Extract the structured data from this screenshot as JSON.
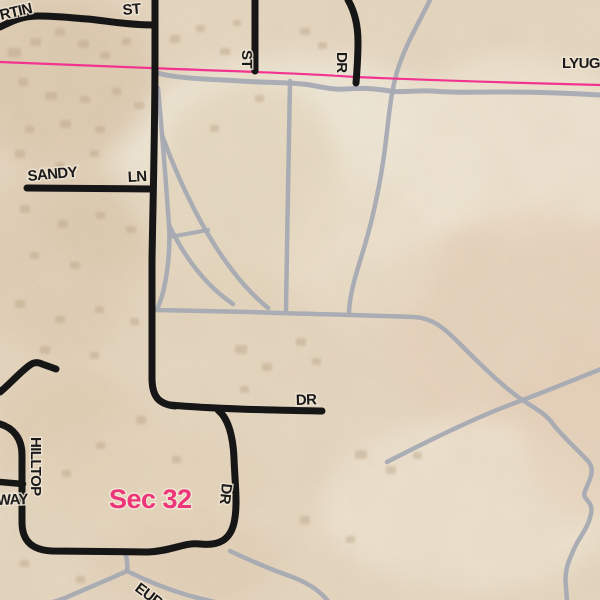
{
  "map": {
    "colors": {
      "base": "#e6d7c1",
      "road": "#161616",
      "trail": "#a6aab3",
      "boundary": "#f23390",
      "label": "#1a1a1a",
      "section_label": "#ec3679",
      "building": "#b59e7f"
    },
    "background": {
      "patches": [
        [
          300,
          165,
          190,
          110,
          "#f2ebdb",
          0.9
        ],
        [
          520,
          150,
          130,
          95,
          "#f0e6d4",
          0.85
        ],
        [
          530,
          330,
          140,
          120,
          "#e8d3bd",
          0.7
        ],
        [
          470,
          505,
          150,
          85,
          "#efe5d3",
          0.8
        ],
        [
          60,
          80,
          95,
          85,
          "#d9c4a7",
          0.55
        ],
        [
          55,
          265,
          85,
          95,
          "#dccaae",
          0.5
        ],
        [
          110,
          220,
          65,
          45,
          "#d9c6a9",
          0.45
        ],
        [
          250,
          185,
          95,
          105,
          "#e2d1b6",
          0.6
        ],
        [
          70,
          430,
          75,
          65,
          "#decaac",
          0.5
        ],
        [
          185,
          560,
          95,
          45,
          "#e1ceb3",
          0.5
        ],
        [
          590,
          430,
          70,
          90,
          "#e7d1bb",
          0.6
        ],
        [
          360,
          250,
          80,
          70,
          "#ecdfca",
          0.7
        ],
        [
          150,
          480,
          120,
          60,
          "#e6d6bd",
          0.6
        ]
      ],
      "buildings": [
        [
          8,
          48,
          13,
          9
        ],
        [
          30,
          38,
          11,
          8
        ],
        [
          55,
          28,
          10,
          8
        ],
        [
          78,
          40,
          11,
          8
        ],
        [
          100,
          52,
          10,
          7
        ],
        [
          122,
          38,
          9,
          7
        ],
        [
          18,
          78,
          10,
          8
        ],
        [
          45,
          92,
          12,
          8
        ],
        [
          80,
          96,
          10,
          7
        ],
        [
          112,
          88,
          9,
          7
        ],
        [
          134,
          102,
          10,
          7
        ],
        [
          60,
          120,
          11,
          8
        ],
        [
          25,
          126,
          9,
          7
        ],
        [
          95,
          126,
          10,
          7
        ],
        [
          170,
          35,
          10,
          8
        ],
        [
          196,
          25,
          9,
          7
        ],
        [
          220,
          48,
          10,
          7
        ],
        [
          233,
          20,
          8,
          6
        ],
        [
          300,
          28,
          10,
          7
        ],
        [
          318,
          42,
          9,
          7
        ],
        [
          255,
          95,
          9,
          7
        ],
        [
          210,
          125,
          9,
          7
        ],
        [
          15,
          150,
          10,
          8
        ],
        [
          55,
          162,
          9,
          7
        ],
        [
          90,
          150,
          9,
          7
        ],
        [
          20,
          205,
          10,
          8
        ],
        [
          58,
          220,
          10,
          8
        ],
        [
          96,
          212,
          9,
          7
        ],
        [
          126,
          226,
          10,
          7
        ],
        [
          30,
          252,
          9,
          7
        ],
        [
          70,
          262,
          10,
          7
        ],
        [
          15,
          300,
          10,
          8
        ],
        [
          55,
          316,
          10,
          7
        ],
        [
          95,
          306,
          9,
          7
        ],
        [
          130,
          318,
          9,
          7
        ],
        [
          40,
          346,
          10,
          8
        ],
        [
          90,
          352,
          9,
          7
        ],
        [
          235,
          345,
          12,
          9
        ],
        [
          262,
          363,
          10,
          8
        ],
        [
          296,
          338,
          10,
          8
        ],
        [
          240,
          386,
          9,
          7
        ],
        [
          312,
          358,
          9,
          7
        ],
        [
          355,
          450,
          12,
          9
        ],
        [
          386,
          466,
          10,
          8
        ],
        [
          413,
          452,
          9,
          7
        ],
        [
          300,
          516,
          10,
          8
        ],
        [
          346,
          536,
          9,
          7
        ],
        [
          62,
          470,
          9,
          7
        ],
        [
          136,
          416,
          10,
          8
        ],
        [
          96,
          442,
          9,
          7
        ],
        [
          172,
          456,
          9,
          7
        ],
        [
          20,
          560,
          9,
          7
        ],
        [
          76,
          576,
          9,
          7
        ]
      ]
    },
    "trails": [
      {
        "name": "boundary-frontage-trail",
        "w": 5,
        "d": "M 157,73 C 180,79 210,79 240,81 C 270,83 290,82 310,85 C 322,87 332,90 346,89 C 362,88 372,88 390,91 C 402,93 415,90 432,91 C 452,93 470,92 495,92 C 530,92 565,93 600,95"
      },
      {
        "name": "northeast-trail",
        "w": 4.5,
        "d": "M 430,0 C 417,26 404,48 397,72 C 391,92 389,115 386,140 C 382,175 374,215 364,248 C 356,274 350,292 349,312"
      },
      {
        "name": "center-field-trail",
        "w": 4.5,
        "d": "M 290,81 C 289,145 287,235 286,310"
      },
      {
        "name": "roadside-trail",
        "w": 4.5,
        "d": "M 158,88 C 162,132 166,182 169,225 C 171,262 164,295 157,309"
      },
      {
        "name": "fan-trail-a",
        "w": 4.5,
        "d": "M 169,225 C 185,258 205,285 233,304"
      },
      {
        "name": "fan-trail-b",
        "w": 4.5,
        "d": "M 162,135 C 180,185 205,235 232,270 C 244,286 256,298 268,308"
      },
      {
        "name": "fan-connector-trail",
        "w": 4,
        "d": "M 170,237 L 208,230"
      },
      {
        "name": "southeast-trail",
        "w": 4.5,
        "d": "M 156,310 L 250,312 C 292,314 330,314 352,315 L 414,317 C 432,318 443,327 458,342 C 478,362 502,386 521,399 C 536,409 546,414 553,424 C 562,436 576,448 588,461 C 596,470 589,481 585,491 C 581,500 594,500 591,514 C 588,529 579,537 574,549 C 568,562 564,572 566,587 L 567,601"
      },
      {
        "name": "crossing-trail",
        "w": 4.5,
        "d": "M 387,462 C 422,444 472,419 512,404 C 547,391 576,379 601,369"
      },
      {
        "name": "bottom-left-trail",
        "w": 4.5,
        "d": "M 125,551 C 127,559 128,566 127,571 C 110,579 85,589 65,598 C 60,600 54,602 48,603"
      },
      {
        "name": "eureka-trail",
        "w": 4.5,
        "d": "M 127,571 C 147,581 167,589 187,595 C 197,598 207,600 215,602"
      },
      {
        "name": "bottom-east-trail",
        "w": 4.5,
        "d": "M 230,551 C 247,559 267,568 287,575 C 307,582 319,590 328,601"
      }
    ],
    "boundary": {
      "name": "boundary-line",
      "w": 2.2,
      "d": "M 0,62 L 150,68 C 250,72 300,73 355,77 C 450,81 520,83 600,85"
    },
    "roads": [
      {
        "name": "martin-st-road",
        "w": 7,
        "d": "M 0,27 C 12,21 22,16 38,16 C 58,16 72,18 88,19 C 108,21 128,25 153,25"
      },
      {
        "name": "main-road",
        "w": 7,
        "d": "M 155,0 L 155,55 C 155,130 153,200 152,260 L 152,378 C 152,396 158,404 175,406"
      },
      {
        "name": "dr-east-road",
        "w": 7,
        "d": "M 170,405 C 215,409 270,410 322,411"
      },
      {
        "name": "st-stub-road",
        "w": 7,
        "d": "M 255,0 L 255,71"
      },
      {
        "name": "dr-north-road",
        "w": 7,
        "d": "M 348,0 C 355,12 358,26 358,42 C 358,58 357,70 356,83"
      },
      {
        "name": "sandy-ln-road",
        "w": 7,
        "d": "M 27,188 L 152,189"
      },
      {
        "name": "dr-south-road",
        "w": 7,
        "d": "M 218,410 C 229,419 233,437 234,458 C 235,485 238,505 234,523 C 230,540 219,546 200,544"
      },
      {
        "name": "hilltop-way-road",
        "w": 7,
        "d": "M 200,544 C 185,542 172,551 148,552 L 52,551 C 32,550 22,541 22,522 L 22,455 C 22,438 13,428 0,424"
      },
      {
        "name": "way-stub-road",
        "w": 6.5,
        "d": "M 0,482 L 23,484"
      },
      {
        "name": "unnamed-west-road",
        "w": 7,
        "d": "M 0,392 C 10,384 20,372 30,365 C 34,362 38,362 42,364 L 56,369"
      }
    ],
    "labels": [
      {
        "name": "road-label-martin",
        "text": "RTIN",
        "x": 1,
        "y": 20,
        "r": -13
      },
      {
        "name": "road-label-martin-st",
        "text": "ST",
        "x": 123,
        "y": 15,
        "r": -5
      },
      {
        "name": "road-label-st",
        "text": "ST",
        "x": 242,
        "y": 50,
        "r": 90
      },
      {
        "name": "road-label-dr-north",
        "text": "DR",
        "x": 337,
        "y": 52,
        "r": 90
      },
      {
        "name": "road-label-lyugo",
        "text": "LYUGO",
        "x": 562,
        "y": 68,
        "r": 0
      },
      {
        "name": "road-label-sandy",
        "text": "SANDY",
        "x": 28,
        "y": 181,
        "r": -5
      },
      {
        "name": "road-label-sandy-ln",
        "text": "LN",
        "x": 128,
        "y": 182,
        "r": -3
      },
      {
        "name": "road-label-dr-east",
        "text": "DR",
        "x": 296,
        "y": 405,
        "r": -2
      },
      {
        "name": "road-label-hilltop",
        "text": "HILLTOP",
        "x": 31,
        "y": 437,
        "r": 90
      },
      {
        "name": "road-label-way",
        "text": "WAY",
        "x": -3,
        "y": 505,
        "r": -2
      },
      {
        "name": "road-label-dr-south",
        "text": "DR",
        "x": 222,
        "y": 483,
        "r": 96
      },
      {
        "name": "road-label-eureka",
        "text": "EURE",
        "x": 134,
        "y": 590,
        "r": 37
      }
    ],
    "section_label": {
      "name": "section-label-sec32",
      "text": "Sec 32",
      "x": 109,
      "y": 508
    }
  }
}
